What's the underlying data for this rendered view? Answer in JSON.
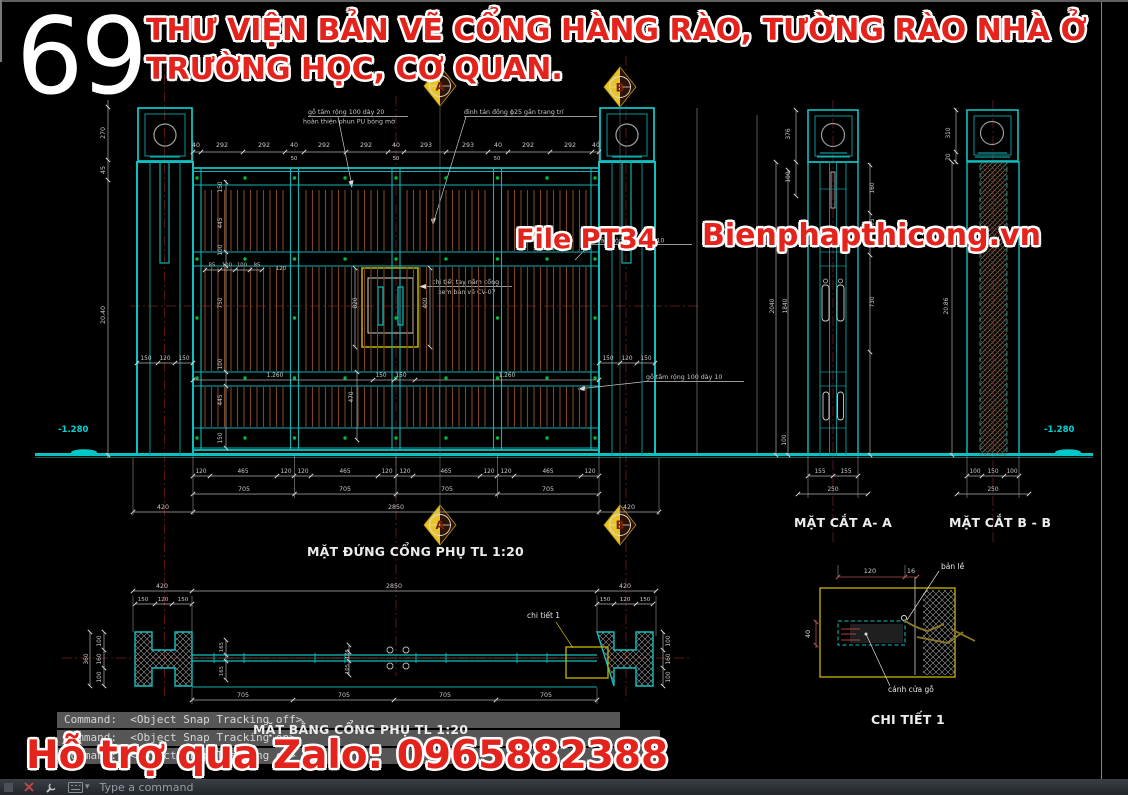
{
  "header": {
    "number": "69",
    "title_line1": "THƯ VIỆN BẢN VẼ CỔNG HÀNG RÀO, TƯỜNG RÀO NHÀ Ở",
    "title_line2": "TRƯỜNG HỌC, CƠ QUAN."
  },
  "watermarks": {
    "file_label": "File PT34",
    "website": "Bienphapthicong.vn",
    "zalo": "Hỗ trợ qua Zalo: 0965882388"
  },
  "views": {
    "elevation": {
      "title": "MẶT ĐỨNG CỔNG PHỤ TL 1:20",
      "dims_top": [
        "40",
        "292",
        "292",
        "40",
        "292",
        "292",
        "40",
        "293",
        "293",
        "40",
        "292",
        "292",
        "40"
      ],
      "dims_top_small": [
        "50",
        "50",
        "50"
      ],
      "dims_left": [
        "270",
        "45",
        "20.40"
      ],
      "dims_pillar_left": [
        "150",
        "120",
        "150"
      ],
      "dims_pillar_right": [
        "150",
        "120",
        "150"
      ],
      "dims_inner_left": [
        "150",
        "445",
        "100",
        "750",
        "100",
        "445",
        "150"
      ],
      "dims_inner_mid": [
        "820",
        "400",
        "470"
      ],
      "dims_mid_row": [
        "85",
        "100",
        "100",
        "85",
        "120"
      ],
      "dims_leaf_row": [
        "1.260",
        "150",
        "150",
        "1.260"
      ],
      "dims_bottom_panels": [
        "120",
        "465",
        "120",
        "120",
        "465",
        "120",
        "120",
        "465",
        "120",
        "120",
        "465",
        "120"
      ],
      "dims_bottom_leaf": [
        "705",
        "705",
        "705",
        "705"
      ],
      "dims_bottom_total": [
        "420",
        "2850",
        "420"
      ],
      "level_left": "-1.280",
      "level_right": "-1.280"
    },
    "section_a": {
      "title": "MẶT CẮT A- A",
      "dims_left": [
        "376",
        "100",
        "2040",
        "1840"
      ],
      "dims_right": [
        "160",
        "305",
        "730"
      ],
      "dim_base": "100",
      "dims_bottom": [
        "155",
        "155",
        "250"
      ]
    },
    "section_b": {
      "title": "MẶT CẮT B - B",
      "dims_left": [
        "310",
        "20",
        "20.86"
      ],
      "dims_bottom": [
        "100",
        "150",
        "100",
        "250"
      ]
    },
    "plan": {
      "title": "MẶT BẰNG CỔNG PHỤ TL 1:20",
      "dims_top": [
        "420",
        "2850",
        "420"
      ],
      "dims_pillar_left": [
        "150",
        "120",
        "150"
      ],
      "dims_pillar_right": [
        "150",
        "120",
        "150"
      ],
      "dims_left": [
        "100",
        "160",
        "100",
        "360"
      ],
      "dims_right": [
        "100",
        "160",
        "100"
      ],
      "dims_mid": [
        "165",
        "165",
        "105",
        "105"
      ],
      "dims_bottom": [
        "705",
        "705",
        "705",
        "705"
      ],
      "detail_ref": "chi tiết 1"
    },
    "detail": {
      "title": "CHI TIẾT 1",
      "dim_width": "120",
      "dim_hinge": "16",
      "dim_height": "40",
      "label_hinge": "bản lề",
      "label_leaf": "cánh cửa gỗ"
    }
  },
  "annotations": {
    "wood_top": "gỗ tấm rộng 100 dày 20",
    "finish": "hoàn thiện phun PU bóng mờ",
    "rivet": "đinh tán đồng ϕ25 gắn trang trí",
    "handle_line1": "chi tiết tay nắm cổng",
    "handle_line2": "xem bản vẽ CV-07",
    "wood_mid": "gỗ tấm rộng 100 dày 10",
    "wood_bottom": "gỗ tấm rộng 100 dày 10"
  },
  "markers": {
    "a": "A",
    "b": "B"
  },
  "command": {
    "lines": [
      "Command:  <Object Snap Tracking off>",
      "Command:  <Object Snap Tracking on>",
      "Command:  <Object Snap Tracking on>"
    ],
    "input_placeholder": "Type a command"
  },
  "colors": {
    "cad_cyan": "#10c0c0",
    "wood": "#7e4626",
    "dim_gray": "#c8c8c8",
    "accent_red": "#e3231c",
    "marker_gold": "#e8c428",
    "detail_yellow": "#c8b400",
    "dot_green": "#00bc3c",
    "level_cyan": "#00d2d2"
  }
}
